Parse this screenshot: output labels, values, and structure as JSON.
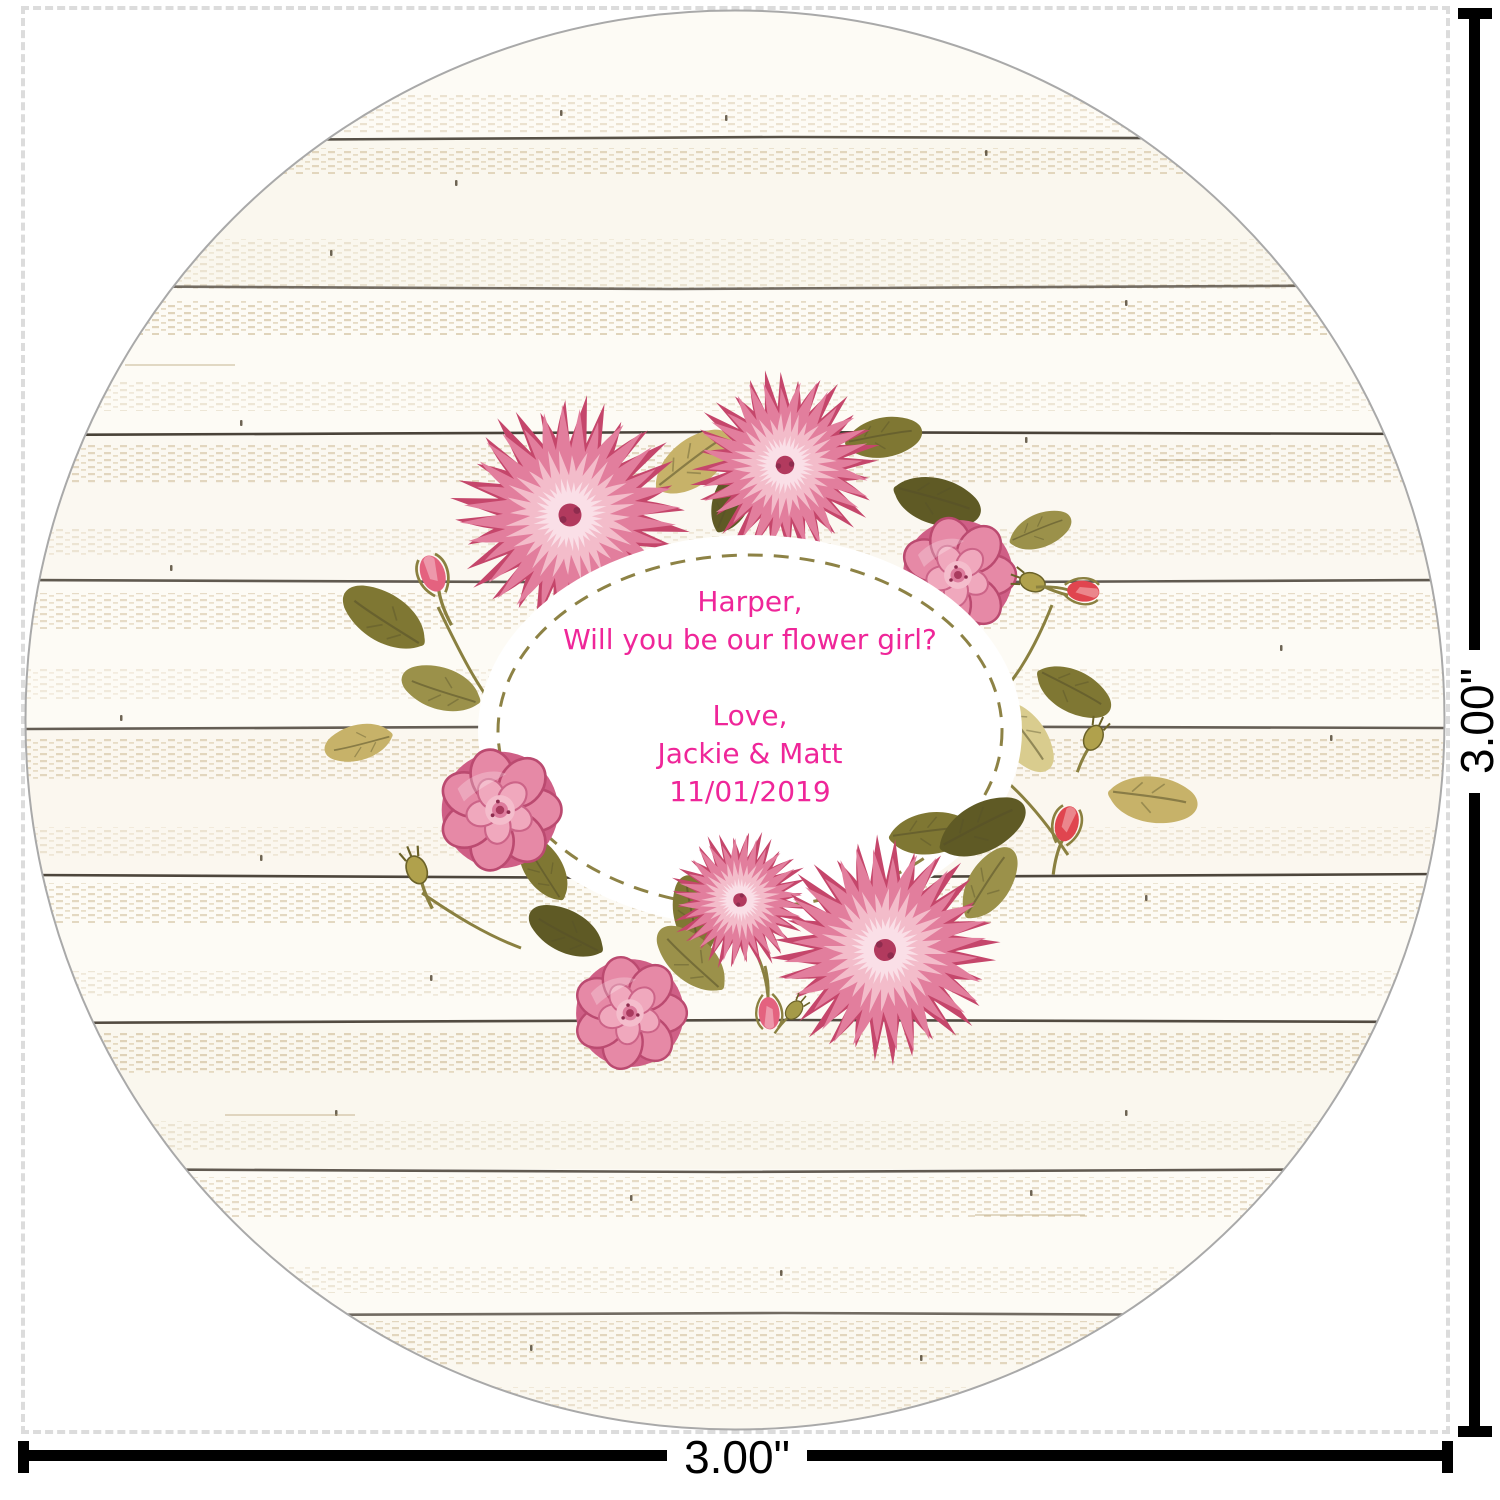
{
  "page": {
    "width": 1500,
    "height": 1500,
    "background": "#ffffff"
  },
  "sticker": {
    "shape": "circle",
    "background_style": "white shiplap wood planks",
    "wood_colors": {
      "base": "#fdfbf5",
      "plank_tint": "#f1e9d4",
      "grain": "#c9b48c",
      "seam": "#3a3228",
      "edge": "#a9a9a9"
    },
    "wreath_colors": {
      "pink_deep": "#c5466b",
      "pink_mid": "#e27e9d",
      "pink_light": "#f3bcca",
      "pink_pale": "#fadfe7",
      "flower_center": "#a93a5e",
      "olive": "#7f7733",
      "olive_light": "#9b914a",
      "olive_dark": "#5f5a25",
      "tan": "#c7b269",
      "tan_light": "#d9cc8e",
      "stem": "#8a8040",
      "bud_red": "#e0454f"
    },
    "label": {
      "oval_fill": "#ffffff",
      "dash_color": "#8d8245",
      "text_color": "#ef2699",
      "lines": [
        "Harper,",
        "Will you be our flower girl?",
        "",
        "Love,",
        "Jackie & Matt",
        "11/01/2019"
      ]
    }
  },
  "guides": {
    "dash_color": "#dcdcdc",
    "line_color": "#000000",
    "width_label": "3.00\"",
    "height_label": "3.00\""
  }
}
